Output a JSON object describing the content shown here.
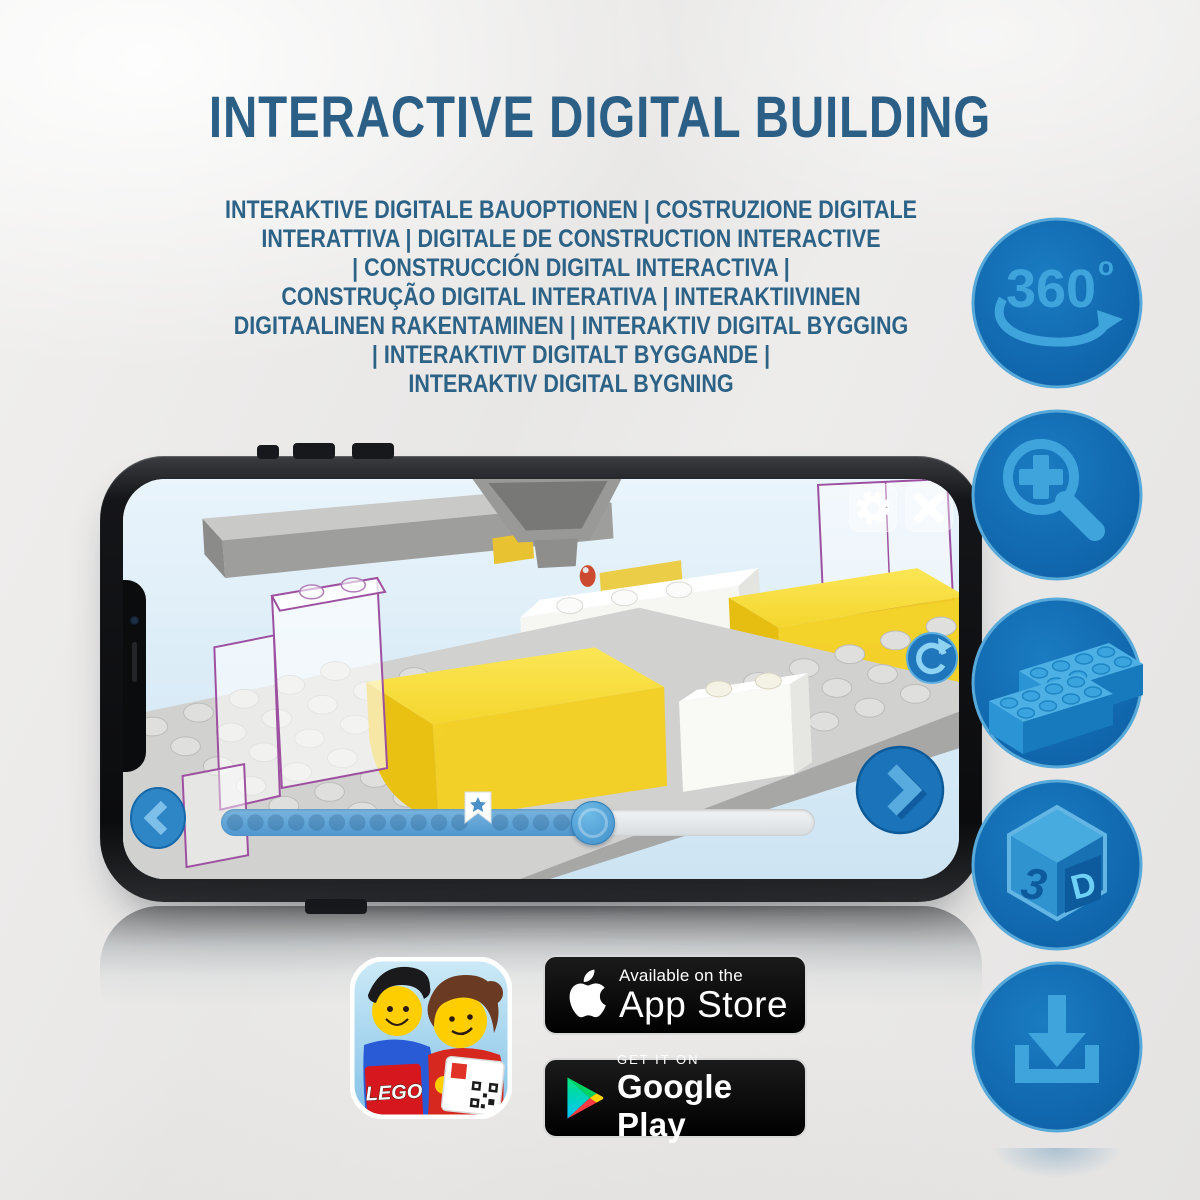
{
  "title": "INTERACTIVE DIGITAL BUILDING",
  "subtitle": {
    "lines": [
      "INTERAKTIVE DIGITALE BAUOPTIONEN | COSTRUZIONE DIGITALE",
      "INTERATTIVA | DIGITALE DE CONSTRUCTION INTERACTIVE",
      "| CONSTRUCCIÓN DIGITAL INTERACTIVA |",
      "CONSTRUÇÃO DIGITAL INTERATIVA | INTERAKTIIVINEN",
      "DIGITAALINEN RAKENTAMINEN | INTERAKTIV DIGITAL BYGGING",
      "| INTERAKTIVT DIGITALT BYGGANDE |",
      "INTERAKTIV DIGITAL BYGNING"
    ]
  },
  "features": [
    {
      "id": "360-rotation",
      "label": "360",
      "sup": "o"
    },
    {
      "id": "zoom-in"
    },
    {
      "id": "brick-building-options"
    },
    {
      "id": "3d-view",
      "left": "3",
      "right": "D"
    },
    {
      "id": "offline-download"
    }
  ],
  "badges": {
    "app_store": {
      "tagline": "Available on the",
      "name": "App Store"
    },
    "google_play": {
      "tagline": "GET IT ON",
      "name": "Google Play"
    }
  },
  "app_icon": {
    "logo_text": "LEGO"
  },
  "colors": {
    "title_text": "#2c5f86",
    "feature_circle": "#1373ba",
    "feature_glyph": "#3fa3dc",
    "lego_yellow": "#f3d01f",
    "screen_bg": "#ddedf8",
    "ghost_outline": "#9d50a0"
  }
}
